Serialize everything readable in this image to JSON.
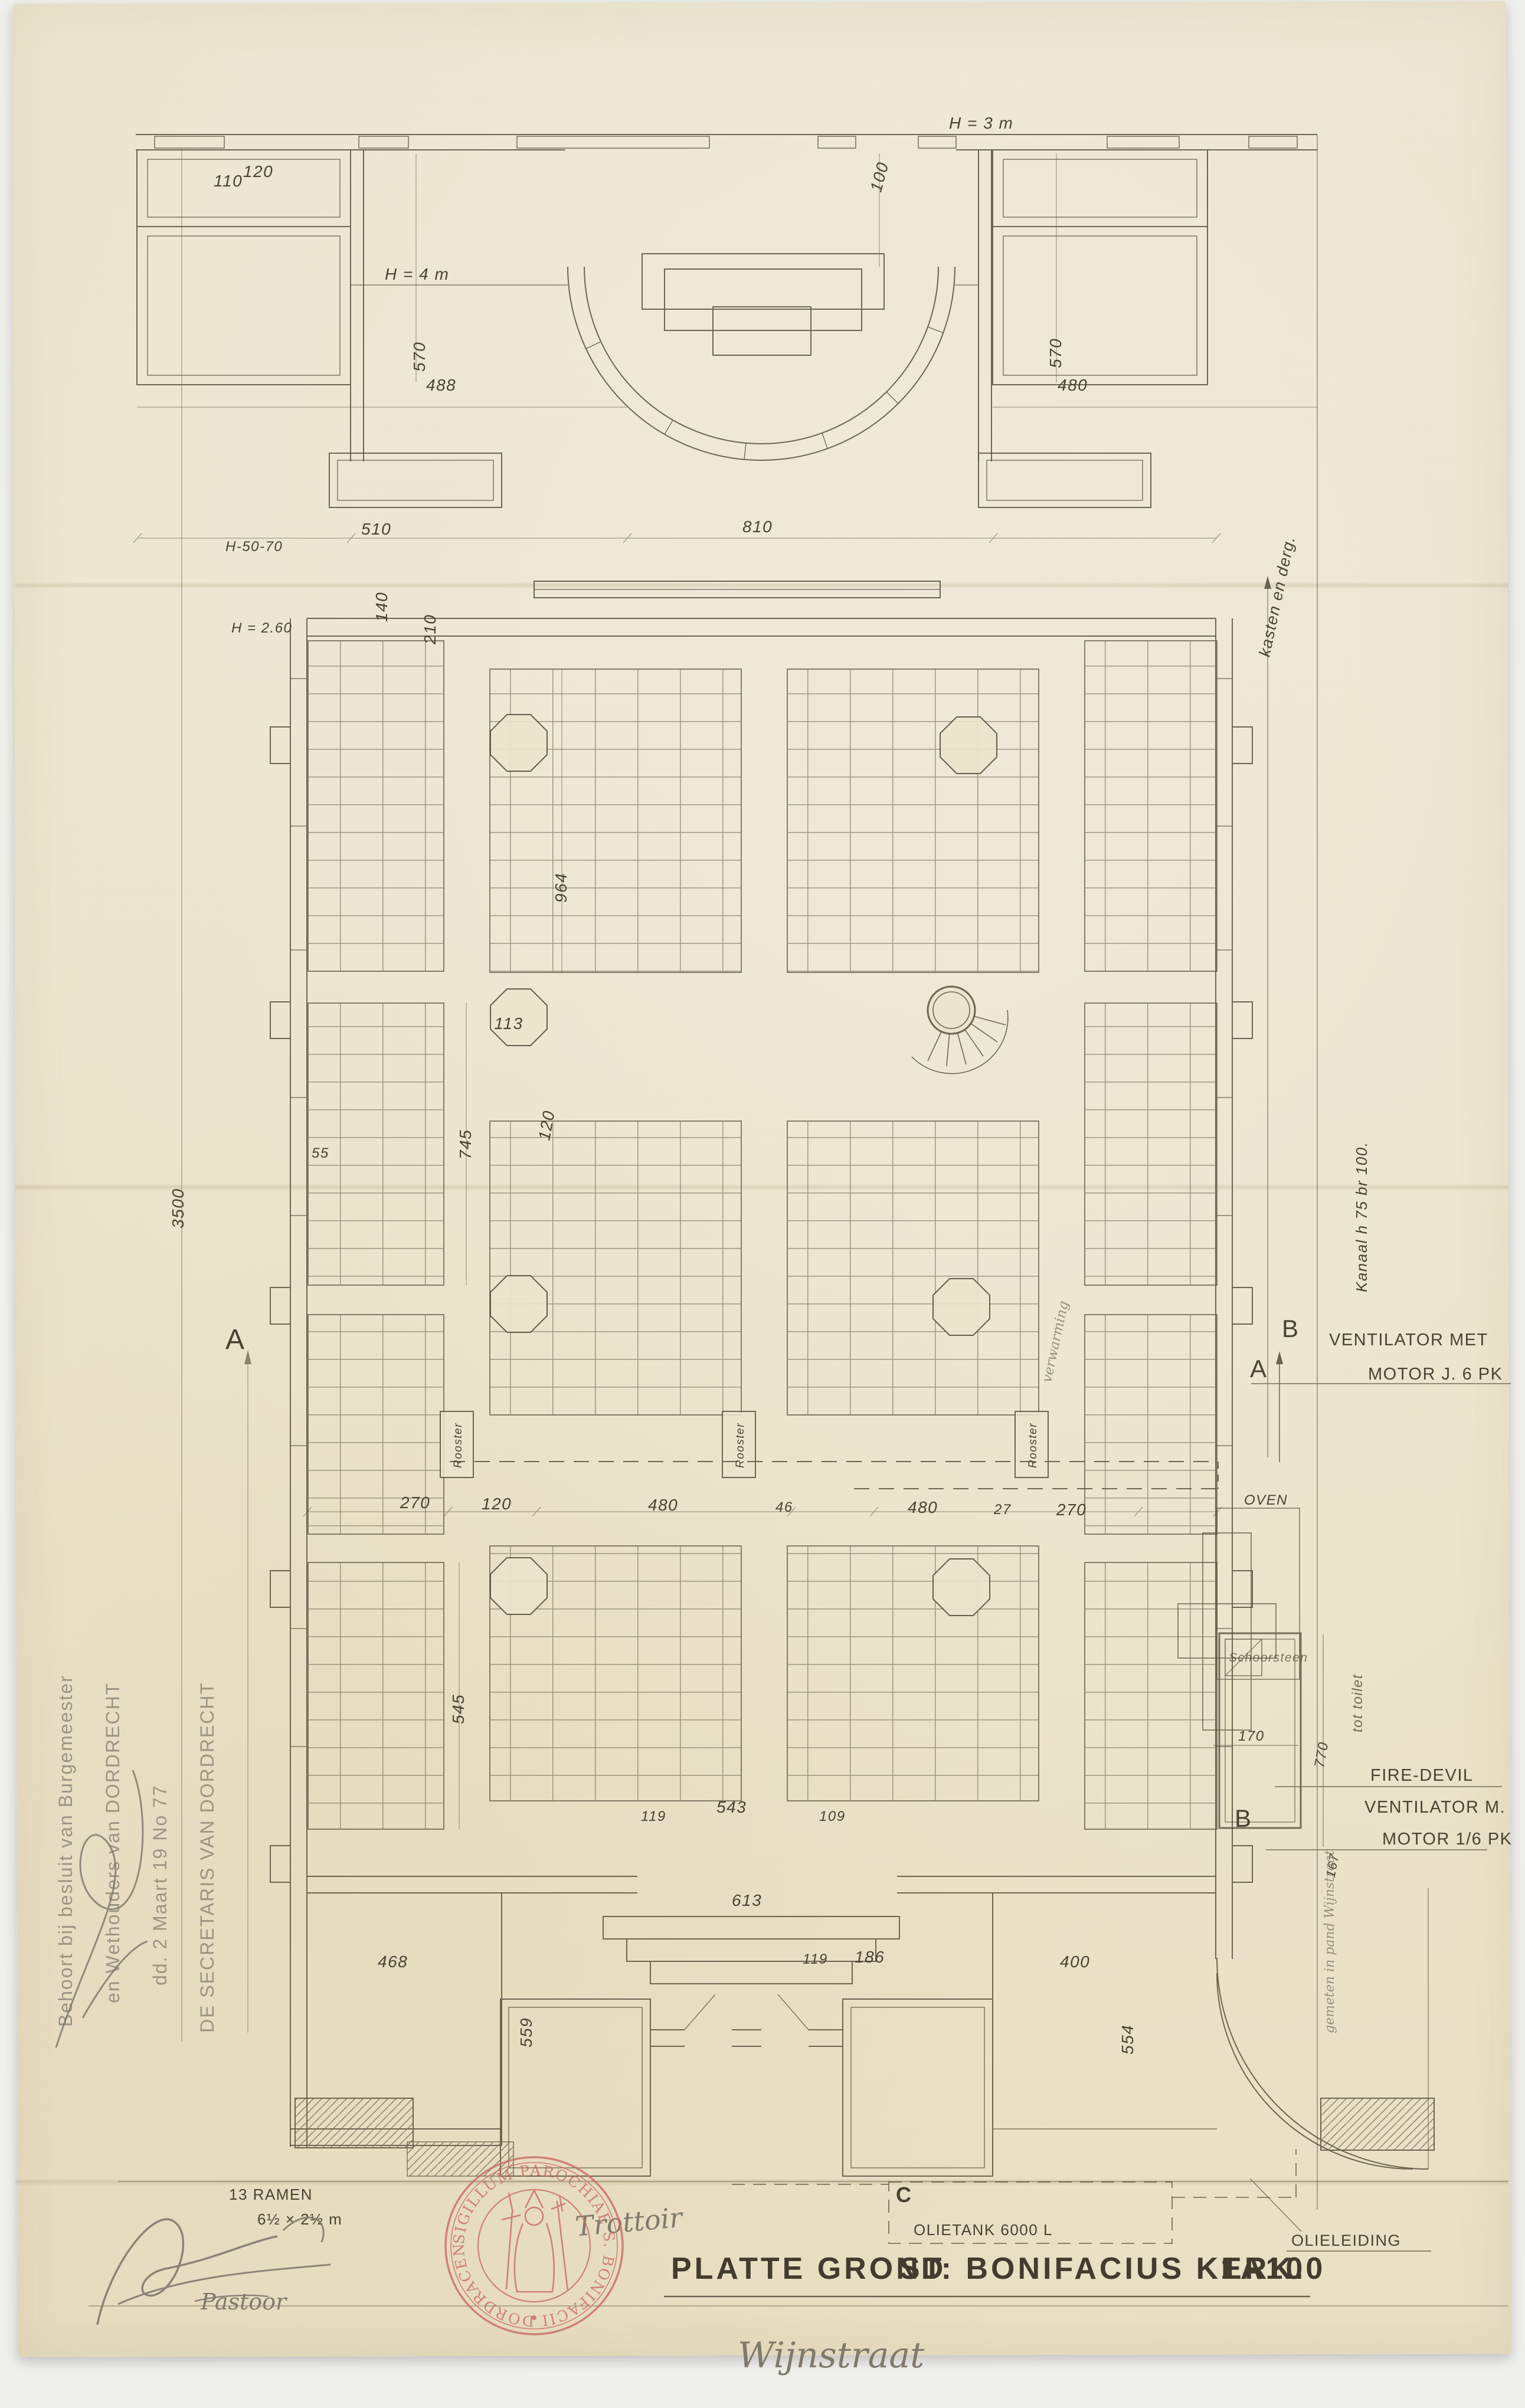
{
  "colors": {
    "ink": "#4a4334",
    "pencil": "#807a6c",
    "stamp_red": "#c96e63",
    "paper": "#ece4cd"
  },
  "title": {
    "part1": "PLATTE GROND",
    "part2": "ST: BONIFACIUS KERK.",
    "scale": "1A100"
  },
  "street": {
    "name": "Wijnstraat",
    "sidewalk": "Trottoir"
  },
  "oil": {
    "marker": "C",
    "tank": "OLIETANK 6000 L",
    "leiding": "OLIELEIDING"
  },
  "vent_top": {
    "l1": "VENTILATOR MET",
    "l2": "MOTOR J. 6 PK"
  },
  "vent_bottom": {
    "l1": "FIRE-DEVIL",
    "l2": "VENTILATOR M.",
    "l3": "MOTOR 1/6 PK"
  },
  "sections": {
    "a_left": "A",
    "a_right": "A",
    "b_top": "B",
    "b_bottom": "B"
  },
  "windows_note": {
    "l1": "13 RAMEN",
    "l2": "6½ × 2½ m"
  },
  "pastoor_note": "Pastoor",
  "approval": {
    "l1": "Behoort bij besluit van Burgemeester",
    "l2": "en Wethouders van DORDRECHT",
    "l3": "dd. 2 Maart 19   No 77",
    "l4": "DE SECRETARIS VAN DORDRECHT"
  },
  "stamp": {
    "ring": "SIGILLUM PAROCHIAE S. BONIFACII DORDRACENAE"
  },
  "notes": {
    "kanaal": "Kanaal h 75 br 100.",
    "kasten": "kasten en derg.",
    "oven": "OVEN",
    "schoorsteen": "Schoorsteen",
    "toilet": "tot toilet",
    "gemeten": "gemeten in pand Wijnstraat",
    "verwarming": "verwarming",
    "rooster": "Rooster"
  },
  "dims": {
    "d01": "H = 3 m",
    "d02": "110",
    "d03": "120",
    "d04": "100",
    "d05": "H = 4 m",
    "d06": "570",
    "d07": "488",
    "d08": "570",
    "d09": "480",
    "d10": "510",
    "d11": "810",
    "d12": "140",
    "d13": "210",
    "d14": "H-50-70",
    "d15": "H = 2.60",
    "d16": "964",
    "d17": "745",
    "d18": "55",
    "d19": "113",
    "d20": "120",
    "d21": "3500",
    "d22": "270",
    "d23": "120",
    "d24": "480",
    "d25": "46",
    "d26": "480",
    "d27": "27",
    "d28": "270",
    "d29": "545",
    "d30": "119",
    "d31": "543",
    "d32": "109",
    "d33": "613",
    "d34": "119",
    "d35": "186",
    "d36": "468",
    "d37": "400",
    "d38": "559",
    "d39": "554",
    "d40": "170",
    "d41": "770",
    "d42": "167"
  }
}
